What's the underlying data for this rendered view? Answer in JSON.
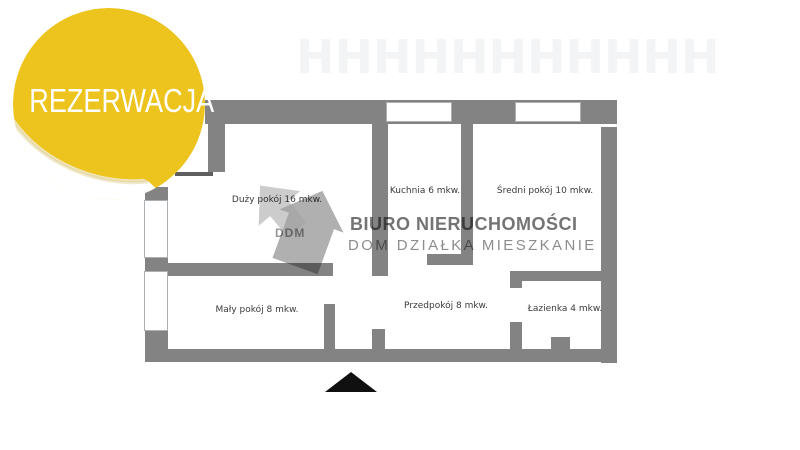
{
  "badge": {
    "label": "REZERWACJA"
  },
  "watermark": {
    "logo_text": "DDM",
    "line1": "BIURO NIERUCHOMOŚCI",
    "line2": "DOM DZIAŁKA MIESZKANIE"
  },
  "floorplan": {
    "rooms": [
      {
        "id": "duzy-pokoj",
        "label": "Duży pokój 16 mkw."
      },
      {
        "id": "kuchnia",
        "label": "Kuchnia 6 mkw."
      },
      {
        "id": "sredni-pokoj",
        "label": "Średni pokój 10 mkw."
      },
      {
        "id": "maly-pokoj",
        "label": "Mały pokój 8 mkw."
      },
      {
        "id": "przedpokoj",
        "label": "Przedpokój 8 mkw."
      },
      {
        "id": "lazienka",
        "label": "Łazienka 4 mkw."
      }
    ],
    "entrance_marker": "entrance-triangle"
  },
  "colors": {
    "badge_yellow": "#edc41e",
    "wall_gray": "#838383",
    "watermark_dark_gray": "#747474",
    "watermark_light_gray": "#8d8d8d",
    "entrance_black": "#101010"
  },
  "faint_pattern": "HHHHHHHHHHH"
}
